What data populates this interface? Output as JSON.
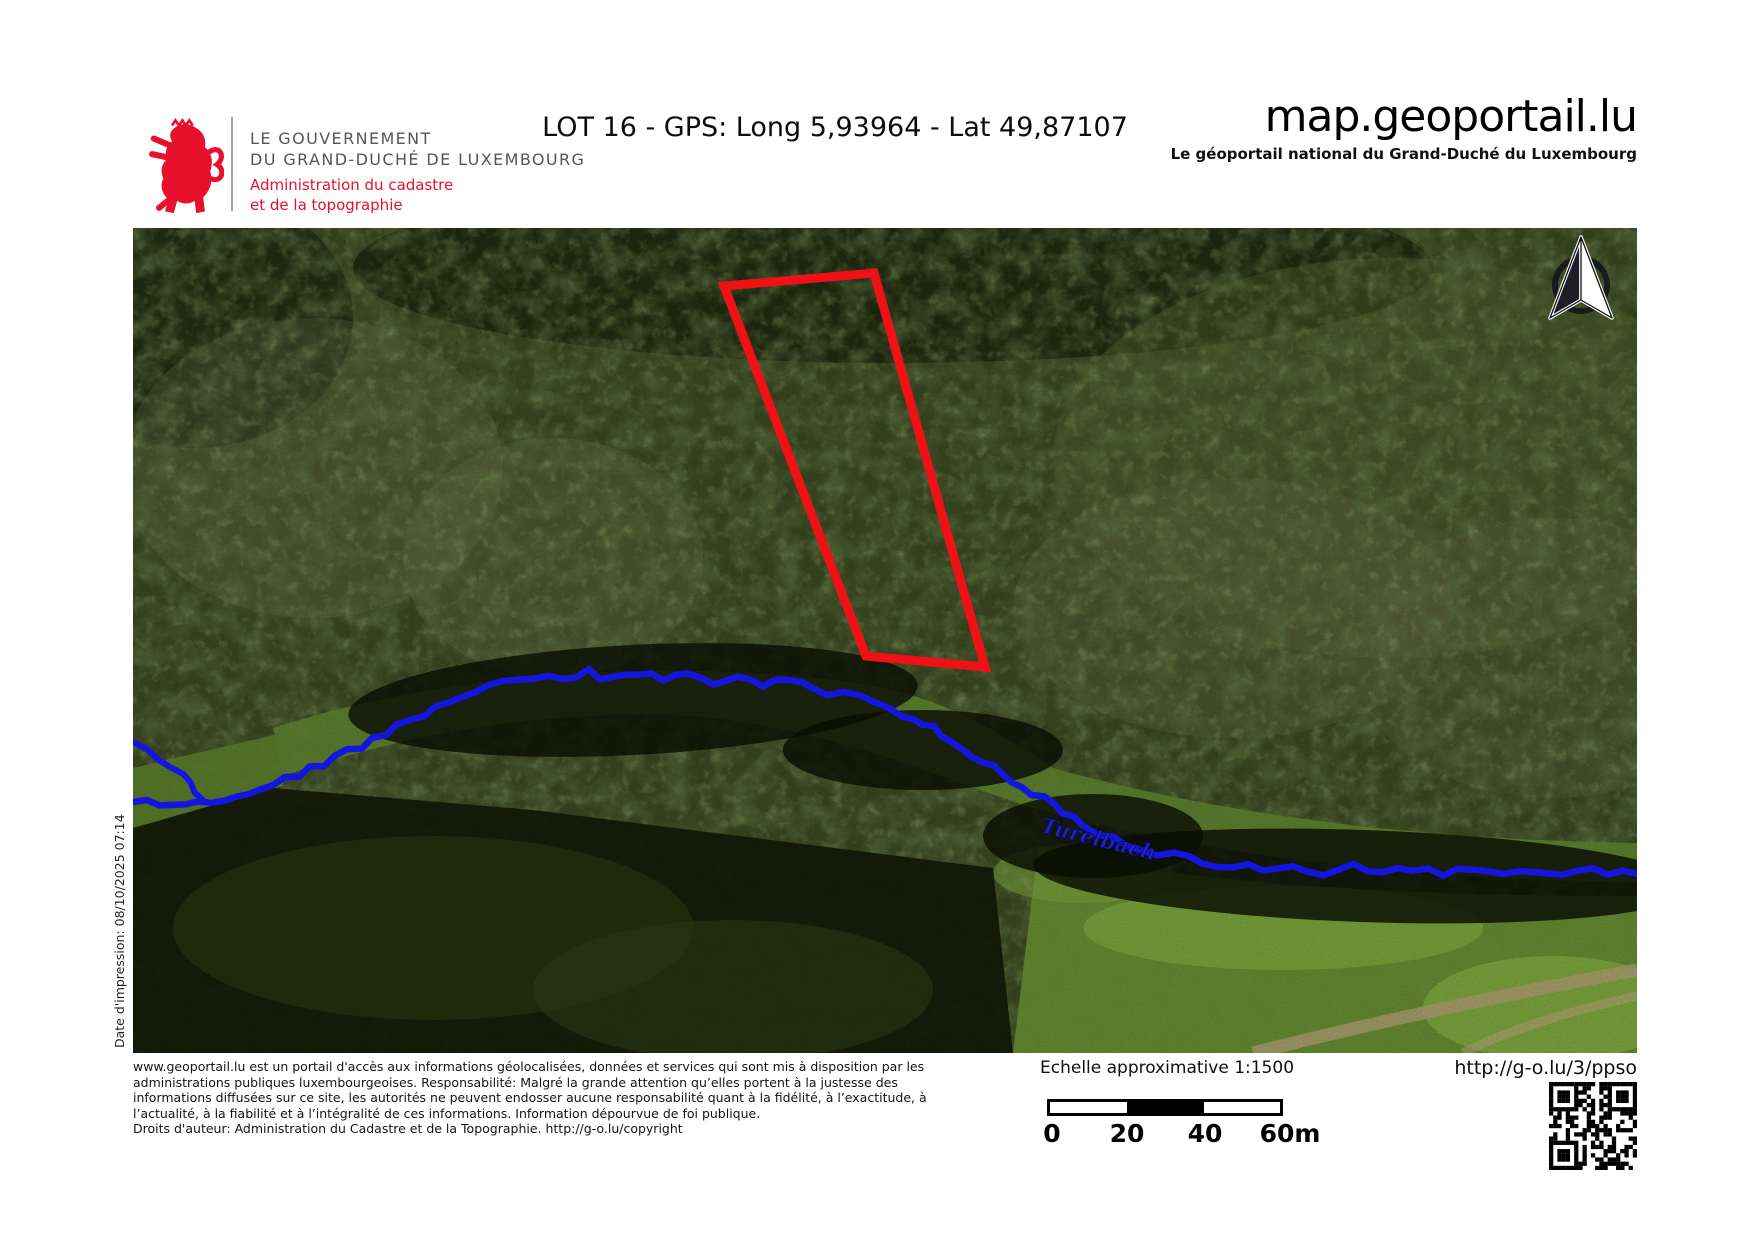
{
  "header": {
    "logo": {
      "line1": "LE GOUVERNEMENT",
      "line2": "DU GRAND-DUCHÉ DE LUXEMBOURG",
      "line3": "Administration du cadastre",
      "line4": "et de la topographie"
    },
    "title": "LOT 16 - GPS: Long 5,93964 - Lat 49,87107",
    "site": "map.geoportail.lu",
    "site_subtitle": "Le géoportail national du Grand-Duché du Luxembourg"
  },
  "sidebar": {
    "print_date": "Date d'impression: 08/10/2025 07:14"
  },
  "map": {
    "river_label": "Turelbach",
    "river_label_pos": [
      907,
      604
    ],
    "river_label_angle": 14,
    "river_color": "#1515e0",
    "river_label_color": "#1f1fd6",
    "parcel_color": "#ee1116",
    "parcel_points": [
      [
        591,
        58
      ],
      [
        741,
        45
      ],
      [
        852,
        439
      ],
      [
        733,
        428
      ]
    ],
    "river_points": [
      [
        0,
        574
      ],
      [
        40,
        576
      ],
      [
        90,
        570
      ],
      [
        140,
        556
      ],
      [
        190,
        536
      ],
      [
        240,
        512
      ],
      [
        290,
        486
      ],
      [
        330,
        468
      ],
      [
        370,
        456
      ],
      [
        400,
        450
      ],
      [
        430,
        452
      ],
      [
        455,
        444
      ],
      [
        480,
        452
      ],
      [
        505,
        444
      ],
      [
        530,
        452
      ],
      [
        555,
        445
      ],
      [
        580,
        455
      ],
      [
        605,
        449
      ],
      [
        630,
        458
      ],
      [
        655,
        452
      ],
      [
        680,
        462
      ],
      [
        710,
        466
      ],
      [
        740,
        474
      ],
      [
        770,
        486
      ],
      [
        800,
        500
      ],
      [
        830,
        520
      ],
      [
        860,
        540
      ],
      [
        890,
        558
      ],
      [
        920,
        578
      ],
      [
        950,
        596
      ],
      [
        980,
        610
      ],
      [
        1010,
        620
      ],
      [
        1040,
        628
      ],
      [
        1070,
        634
      ],
      [
        1100,
        638
      ],
      [
        1130,
        641
      ],
      [
        1160,
        640
      ],
      [
        1190,
        644
      ],
      [
        1220,
        638
      ],
      [
        1250,
        644
      ],
      [
        1280,
        640
      ],
      [
        1310,
        646
      ],
      [
        1340,
        641
      ],
      [
        1370,
        647
      ],
      [
        1400,
        642
      ],
      [
        1430,
        648
      ],
      [
        1460,
        643
      ],
      [
        1504,
        646
      ]
    ],
    "river_branch_points": [
      [
        0,
        514
      ],
      [
        26,
        530
      ],
      [
        48,
        548
      ],
      [
        70,
        572
      ]
    ]
  },
  "footer": {
    "disclaimer_lines": [
      "www.geoportail.lu est un portail d'accès aux informations géolocalisées, données et services qui sont mis à disposition par les",
      "administrations publiques luxembourgeoises. Responsabilité: Malgré la grande attention qu’elles portent à la justesse des",
      "informations diffusées sur ce site, les autorités ne peuvent endosser aucune responsabilité quant à la fidélité, à l’exactitude, à",
      "l’actualité, à la fiabilité et à l’intégralité de ces informations. Information dépourvue de foi publique.",
      "Droits d'auteur: Administration du Cadastre et de la Topographie. http://g-o.lu/copyright"
    ],
    "scale_label": "Echelle approximative 1:1500",
    "scale_ticks": [
      "0",
      "20",
      "40",
      "60m"
    ],
    "short_url": "http://g-o.lu/3/ppso"
  },
  "colors": {
    "brand_red": "#e8112d",
    "gov_gray": "#55565a"
  }
}
